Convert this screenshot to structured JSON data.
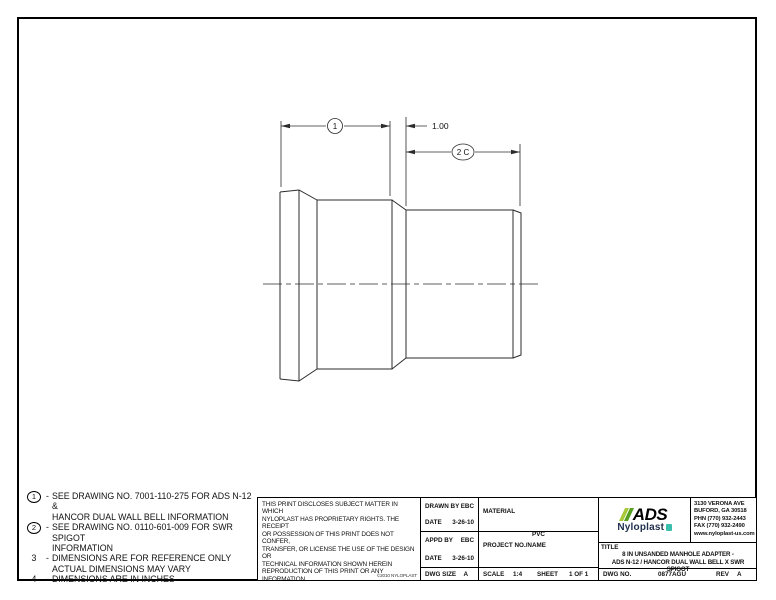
{
  "drawing": {
    "dim1_label": "1",
    "dim2_label": "2 C",
    "gap_dim": "1.00"
  },
  "notes": [
    {
      "num": "1",
      "dash": "-",
      "line1": "SEE DRAWING NO. 7001-110-275 FOR ADS N-12 &",
      "line2": "HANCOR DUAL WALL BELL INFORMATION"
    },
    {
      "num": "2",
      "dash": "-",
      "line1": "SEE DRAWING NO. 0110-601-009 FOR SWR SPIGOT",
      "line2": "INFORMATION"
    },
    {
      "num": "3",
      "dash": "-",
      "line1": "DIMENSIONS ARE FOR REFERENCE ONLY",
      "line2": "ACTUAL DIMENSIONS MAY VARY"
    },
    {
      "num": "4",
      "dash": "-",
      "line1": "DIMENSIONS ARE IN INCHES",
      "line2": ""
    }
  ],
  "disclaimer": {
    "lines": [
      "THIS PRINT DISCLOSES SUBJECT MATTER IN WHICH",
      "NYLOPLAST HAS PROPRIETARY RIGHTS.  THE RECEIPT",
      "OR POSSESSION OF THIS PRINT DOES NOT CONFER,",
      "TRANSFER, OR LICENSE THE USE OF THE DESIGN OR",
      "TECHNICAL INFORMATION SHOWN HEREIN",
      "REPRODUCTION OF THIS PRINT OR ANY INFORMATION",
      "CONTAINED HEREIN, OR MANUFACTURE OF ANY",
      "ARTICLE HEREFROM, FOR THE DISCLOSURE TO OTHERS",
      "IS FORBIDDEN, EXCEPT BY SPECIFIC WRITTEN",
      "PERMISSION FROM NYLOPLAST."
    ],
    "copyright": "©2010 NYLOPLAST"
  },
  "title_block": {
    "drawn_by_label": "DRAWN BY",
    "drawn_by": "EBC",
    "date_label": "DATE",
    "drawn_date": "3-26-10",
    "appd_by_label": "APPD BY",
    "appd_by": "EBC",
    "appd_date": "3-26-10",
    "dwg_size_label": "DWG SIZE",
    "dwg_size": "A",
    "material_label": "MATERIAL",
    "material": "PVC",
    "project_label": "PROJECT NO./NAME",
    "scale_label": "SCALE",
    "scale": "1:4",
    "sheet_label": "SHEET",
    "sheet": "1 OF 1",
    "title_label": "TITLE",
    "title_line1": "8 IN UNSANDED MANHOLE ADAPTER -",
    "title_line2": "ADS N-12 / HANCOR DUAL WALL BELL X SWR SPIGOT",
    "dwg_no_label": "DWG NO.",
    "dwg_no": "0877AGU",
    "rev_label": "REV",
    "rev": "A"
  },
  "company": {
    "logo_text": "ADS",
    "logo_sub": "Nyloplast",
    "address_lines": [
      "3130 VERONA AVE",
      "BUFORD, GA 30518",
      "PHN (770) 932-2443",
      "FAX (770) 932-2490",
      "www.nyloplast-us.com"
    ],
    "colors": {
      "slash_light": "#a9c83a",
      "slash_dark": "#55a11f",
      "mark_teal": "#3bbfad",
      "line_black": "#000000"
    }
  }
}
